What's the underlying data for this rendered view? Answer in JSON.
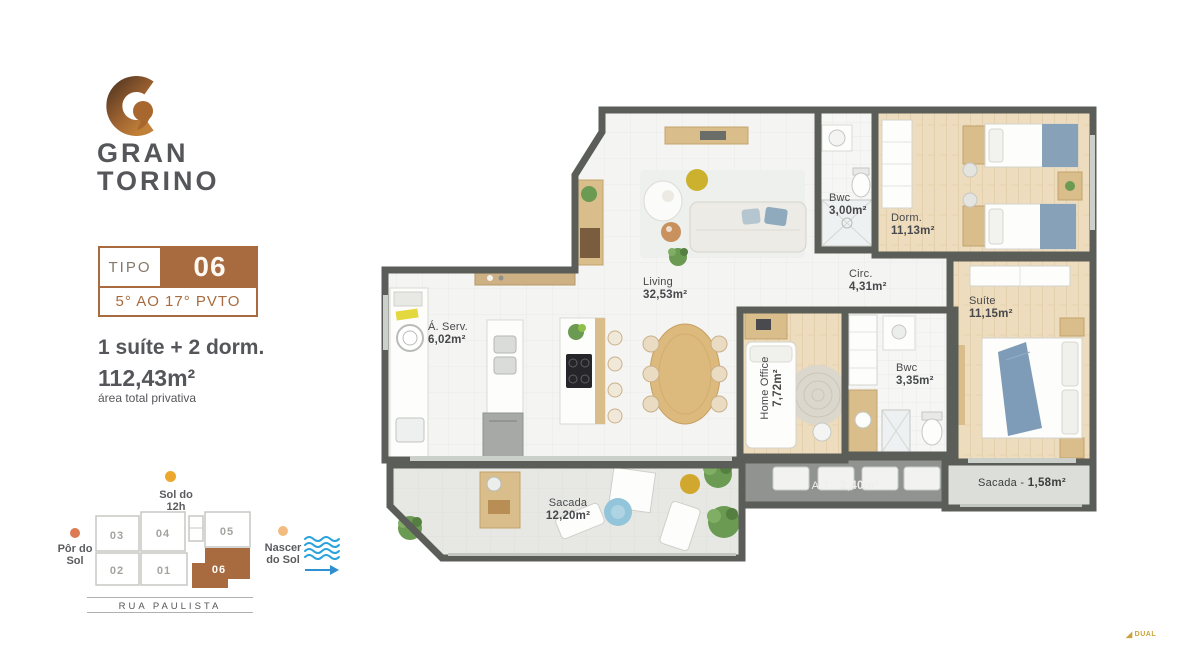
{
  "brand": {
    "line1": "GRAN",
    "line2": "TORINO"
  },
  "unit_card": {
    "tipo_label": "TIPO",
    "unit_number": "06",
    "floors": "5° AO 17° PVTO"
  },
  "summary": {
    "program": "1 suíte + 2 dorm.",
    "area": "112,43m²",
    "caption": "área total privativa"
  },
  "floor_plan": {
    "living": {
      "name": "Living",
      "area": "32,53m²"
    },
    "serv": {
      "name": "Á. Serv.",
      "area": "6,02m²"
    },
    "bwc_social": {
      "name": "Bwc",
      "area": "3,00m²"
    },
    "dorm": {
      "name": "Dorm.",
      "area": "11,13m²"
    },
    "circ": {
      "name": "Circ.",
      "area": "4,31m²"
    },
    "suite": {
      "name": "Suíte",
      "area": "11,15m²"
    },
    "home_office": {
      "name": "Home Office",
      "area": "7,72m²"
    },
    "bwc_suite": {
      "name": "Bwc",
      "area": "3,35m²"
    },
    "sacada": {
      "name": "Sacada",
      "area": "12,20m²"
    },
    "at": {
      "prefix": "A.T - ",
      "area": "2,40m²"
    },
    "sacada_suite": {
      "prefix": "Sacada - ",
      "area": "1,58m²"
    }
  },
  "site_plan": {
    "sun_noon": {
      "line1": "Sol do",
      "line2": "12h"
    },
    "sunset": {
      "line1": "Pôr do",
      "line2": "Sol"
    },
    "sunrise": {
      "line1": "Nascer",
      "line2": "do Sol"
    },
    "street": "RUA PAULISTA",
    "units": {
      "u01": "01",
      "u02": "02",
      "u03": "03",
      "u04": "04",
      "u05": "05",
      "u06": "06"
    },
    "highlighted_unit": "06"
  },
  "watermark": {
    "text": "DUAL"
  },
  "colors": {
    "brand_brown": "#A76B3F",
    "text_dark": "#55565A",
    "wall_gray": "#5B5E58",
    "sun_noon": "#ECA72C",
    "sunset": "#DC7A52",
    "sunrise": "#F2BC80",
    "water_blue": "#2AA3DC"
  }
}
